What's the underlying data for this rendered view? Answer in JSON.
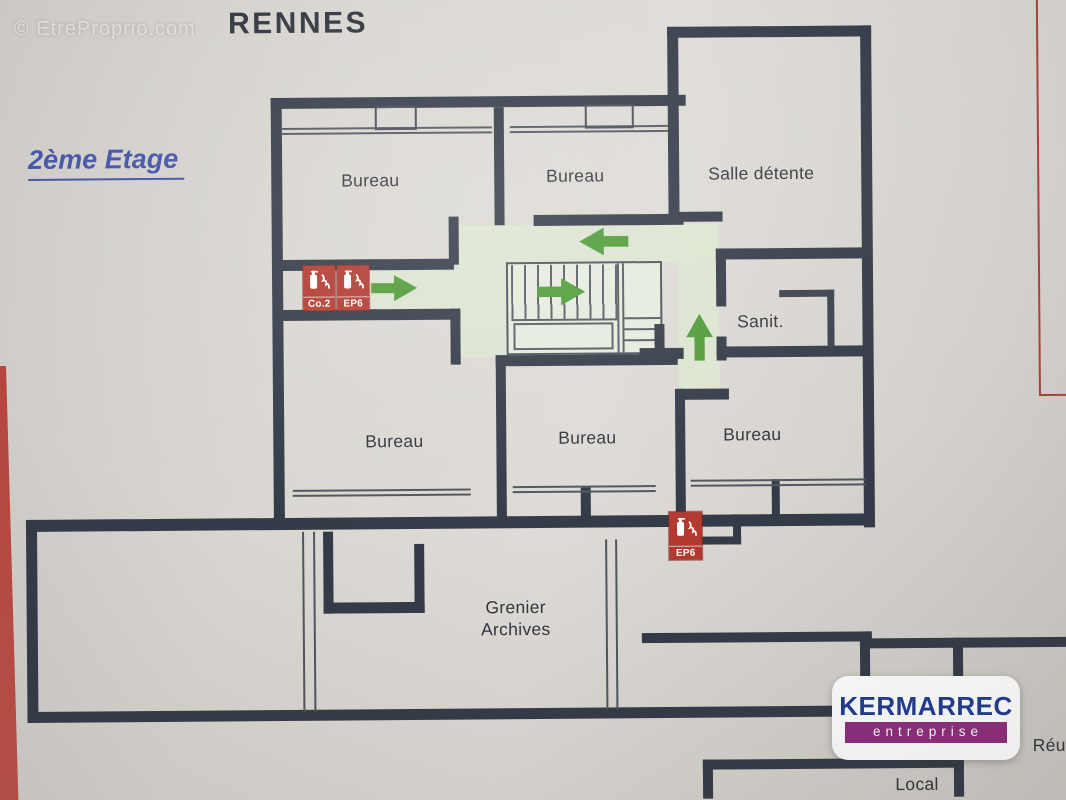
{
  "photo": {
    "watermark": "© EtreProprio.com"
  },
  "header": {
    "building": "RENNES",
    "floor": "2ème Etage"
  },
  "rooms": [
    {
      "id": "bureau-top-left",
      "label": "Bureau"
    },
    {
      "id": "bureau-top-middle",
      "label": "Bureau"
    },
    {
      "id": "salle-detente",
      "label": "Salle détente"
    },
    {
      "id": "sanitaires",
      "label": "Sanit."
    },
    {
      "id": "bureau-bottom-left",
      "label": "Bureau"
    },
    {
      "id": "bureau-bottom-middle",
      "label": "Bureau"
    },
    {
      "id": "bureau-bottom-right",
      "label": "Bureau"
    },
    {
      "id": "grenier-archives",
      "label_line1": "Grenier",
      "label_line2": "Archives"
    },
    {
      "id": "local",
      "label": "Local"
    },
    {
      "id": "reunion-cut",
      "label": "Réu"
    }
  ],
  "safety": {
    "station_left": {
      "extinguisher_1": "Co.2",
      "extinguisher_2": "EP6"
    },
    "station_bottom": {
      "extinguisher_1": "EP6"
    }
  },
  "evacuation_arrows": [
    {
      "id": "arrow-left-arm",
      "direction": "right"
    },
    {
      "id": "arrow-stairs",
      "direction": "right"
    },
    {
      "id": "arrow-top-corridor",
      "direction": "left"
    },
    {
      "id": "arrow-right-corridor",
      "direction": "up"
    }
  ],
  "logo": {
    "brand": "KERMARREC",
    "subtitle": "entreprise"
  },
  "colors": {
    "wall": "#333b48",
    "corridor_green": "#dce5d0",
    "arrow_green": "#4f9b37",
    "extinguisher_red": "#b23a30",
    "floor_title_blue": "#4052a8",
    "frame_red": "#a8423a",
    "logo_blue": "#203c92",
    "logo_purple": "#8e2c7c"
  }
}
